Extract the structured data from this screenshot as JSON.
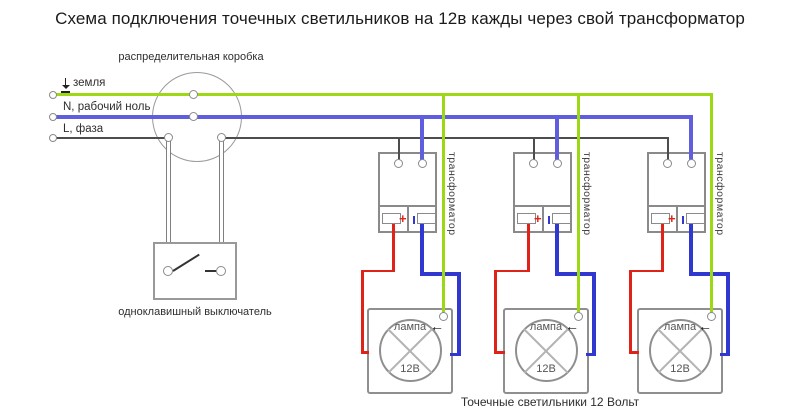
{
  "title": "Схема подключения точечных светильников на 12в кажды через свой трансформатор",
  "junction_box": {
    "label": "распределительная коробка"
  },
  "wires": {
    "ground_label": "земля",
    "neutral_label": "N, рабочий ноль",
    "phase_label": "L, фаза"
  },
  "switch": {
    "label": "одноклавишный выключатель"
  },
  "modules": [
    {
      "transformer_label": "трансформатор",
      "plus_mark": "+",
      "lamp_label": "лампа",
      "lamp_voltage": "12В"
    },
    {
      "transformer_label": "трансформатор",
      "plus_mark": "+",
      "lamp_label": "лампа",
      "lamp_voltage": "12В"
    },
    {
      "transformer_label": "трансформатор",
      "plus_mark": "+",
      "lamp_label": "лампа",
      "lamp_voltage": "12В"
    }
  ],
  "caption": "Точечные светильники 12 Вольт",
  "icons": {
    "left_arrow": "←",
    "ground_symbol": "earth-ground"
  },
  "colors": {
    "ground_wire": "#9cd813",
    "neutral_wire": "#5e5ede",
    "phase_wire": "#4d4d4d",
    "plus_wire": "#e02318",
    "minus_wire": "#3038cf",
    "outline": "#8a8a8a"
  }
}
